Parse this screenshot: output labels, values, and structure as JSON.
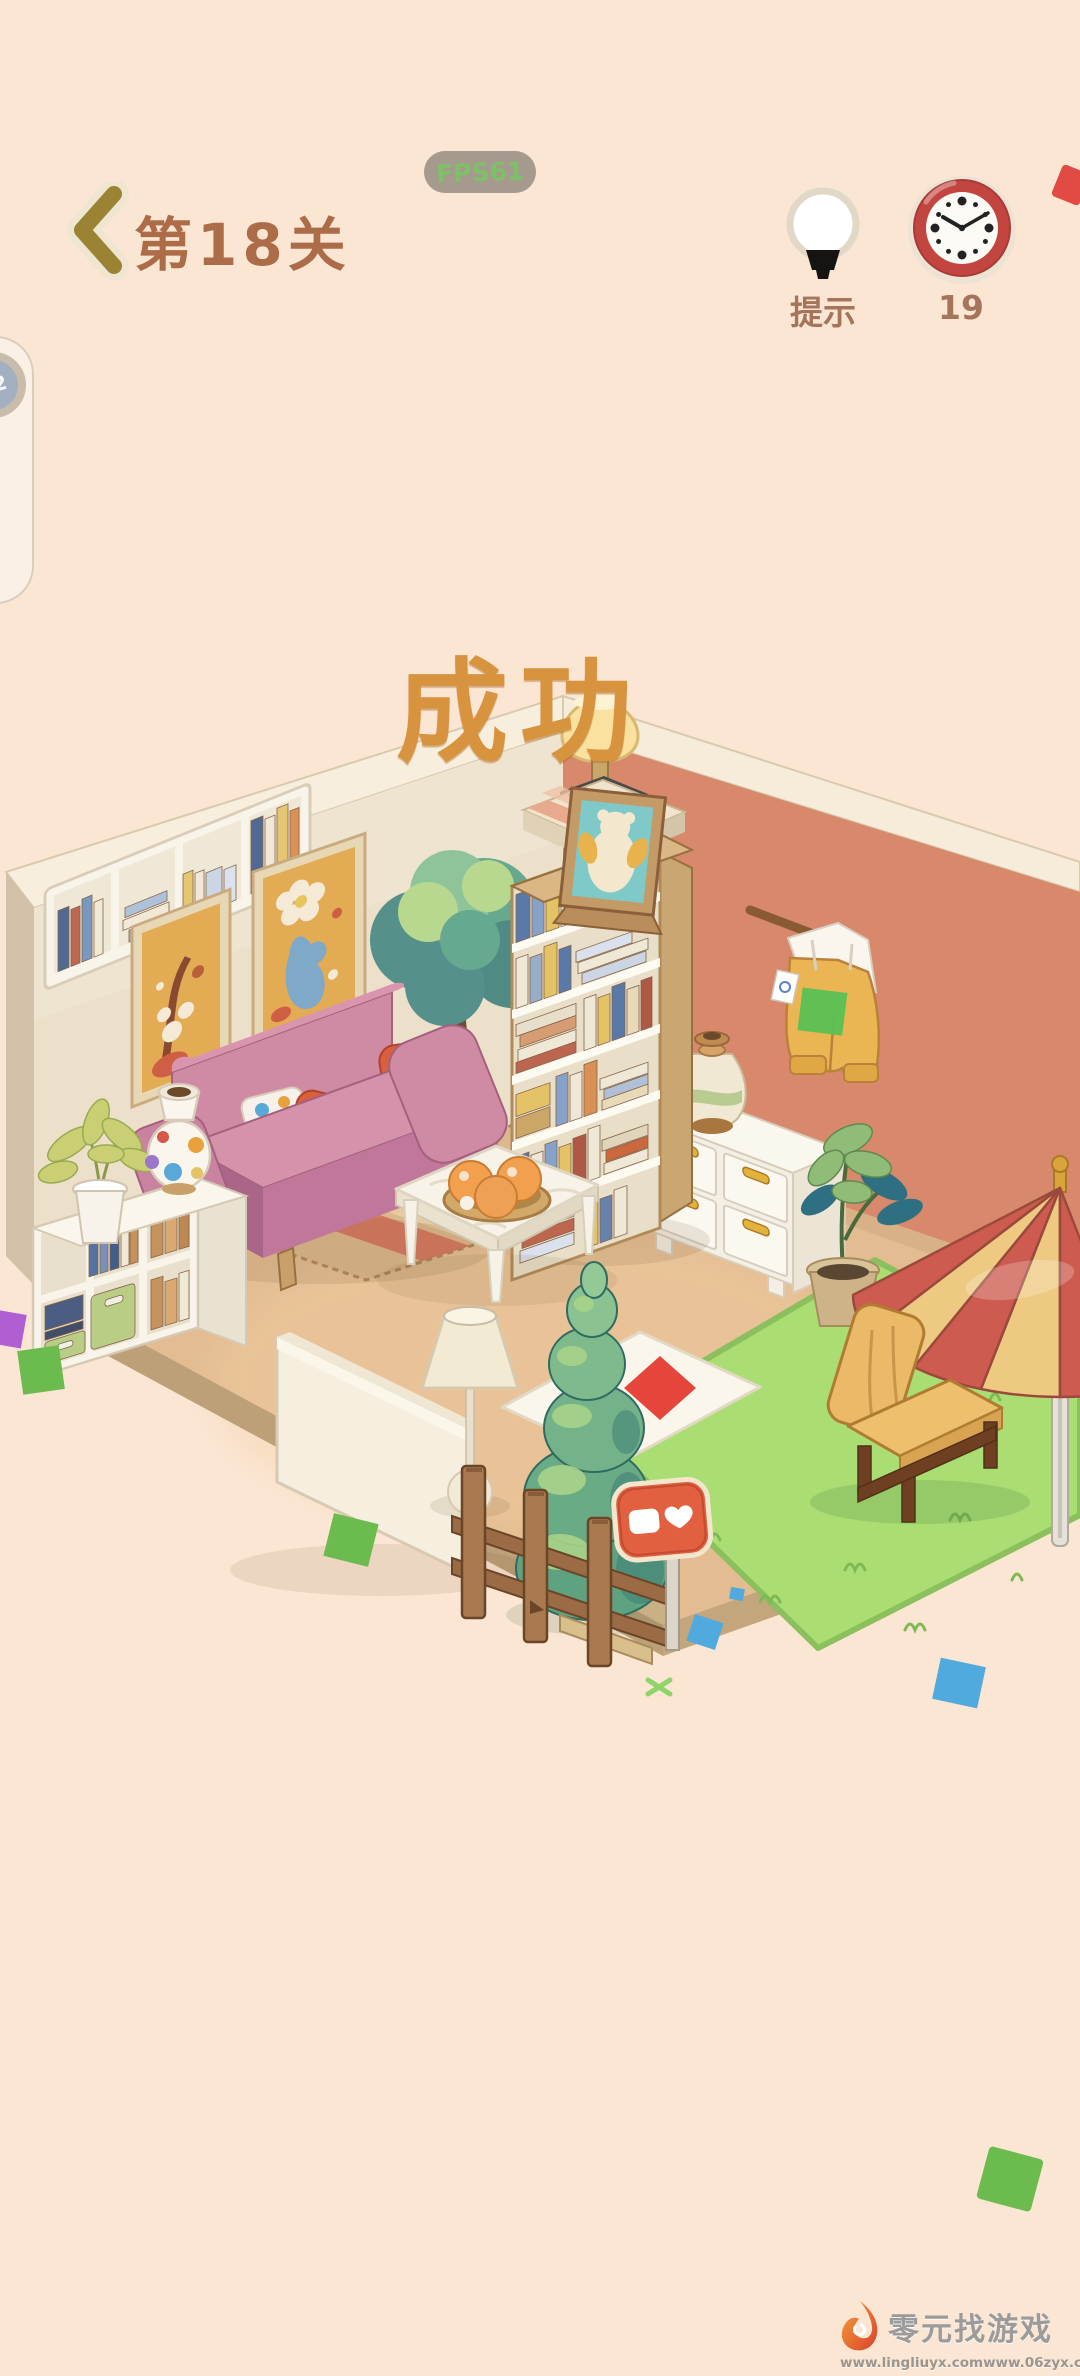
{
  "header": {
    "back_icon": "chevron-left",
    "level_label": "第18关",
    "fps_label": "FPS61",
    "hint": {
      "icon": "lightbulb",
      "label": "提示"
    },
    "timer": {
      "icon": "clock",
      "value": "19",
      "clock_time": "10:08"
    }
  },
  "overlay": {
    "success_label": "成功"
  },
  "side_widget": {
    "badge": "22"
  },
  "watermark": {
    "logo_icon": "flame-logo",
    "title": "零元找游戏",
    "urls": [
      "www.lingliuyx.com",
      "www.06zyx.com"
    ]
  },
  "room": {
    "items": [
      "wall-shelf-books",
      "painting-autumn",
      "painting-flower",
      "indoor-tree",
      "corner-table-lamp",
      "bookcase",
      "bear-picture-frame",
      "hanging-outfit",
      "striped-vase",
      "white-dresser",
      "potted-plant",
      "parasol-umbrella",
      "lounge-chair",
      "grass-platform",
      "floor-mat-red-square",
      "headboard-panel",
      "floor-lamp",
      "pine-topiary",
      "wooden-fence",
      "heart-sign",
      "cubby-cabinet",
      "dotted-vase",
      "cabinet-plant",
      "coffee-table",
      "orange-bowl",
      "pink-sofa",
      "throw-pillows",
      "striped-rug"
    ]
  },
  "palette": {
    "background": "#fbe6d4",
    "header_text": "#ad6c48",
    "back_arrow": "#9a8434",
    "success_text": "#d7933e",
    "hud_label": "#a4755a",
    "clock_red": "#c2453f",
    "wall_left": "#ece0ca",
    "wall_right": "#d8896b",
    "wall_top": "#f8eedd",
    "floor": "#e3bc92",
    "plinth": "#bda077",
    "grass": "#aade72",
    "rug": "#dcb98c",
    "rug_stripe": "#d4725c",
    "sofa_pink": "#cf8aa4",
    "pillow_red": "#d95f3e",
    "umbrella_red": "#cd5b50",
    "umbrella_cream": "#eec981",
    "chair_yellow": "#e6b160",
    "sign_coral": "#e2603f",
    "confetti_green": "#6cbb4e",
    "confetti_blue": "#51aadd",
    "confetti_red": "#e04b43",
    "confetti_purple": "#b05fd3",
    "watermark_text": "#9b9b9b"
  }
}
